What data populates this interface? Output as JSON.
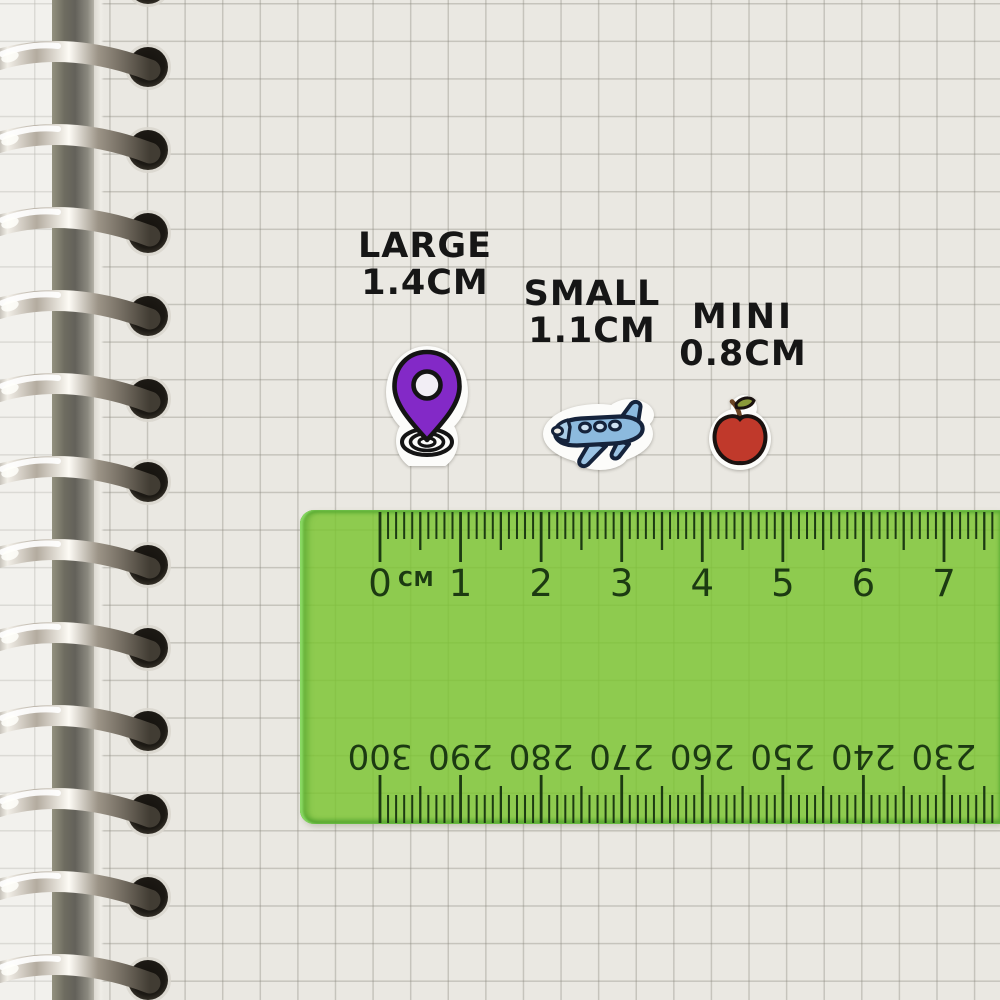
{
  "scene": {
    "description": "Sticker size comparison chart on spiral-bound grid notebook with transparent green ruler"
  },
  "size_labels": [
    {
      "name": "LARGE",
      "size": "1.4CM",
      "sticker": "location-pin"
    },
    {
      "name": "SMALL",
      "size": "1.1CM",
      "sticker": "airplane"
    },
    {
      "name": "MINI",
      "size": "0.8CM",
      "sticker": "apple"
    }
  ],
  "stickers": {
    "location_pin": {
      "name": "location-pin-sticker",
      "color": "#8329c7"
    },
    "airplane": {
      "name": "airplane-sticker",
      "color": "#8cbade"
    },
    "apple": {
      "name": "apple-sticker",
      "color": "#c0392b"
    }
  },
  "ruler": {
    "unit_label": "CM",
    "cm_numbers": [
      "0",
      "1",
      "2",
      "3",
      "4",
      "5",
      "6",
      "7"
    ],
    "mm_numbers": [
      "300",
      "290",
      "280",
      "270",
      "260",
      "250",
      "240",
      "230"
    ],
    "colors": {
      "body": "#7cc532",
      "markings": "#1c3a12"
    }
  }
}
